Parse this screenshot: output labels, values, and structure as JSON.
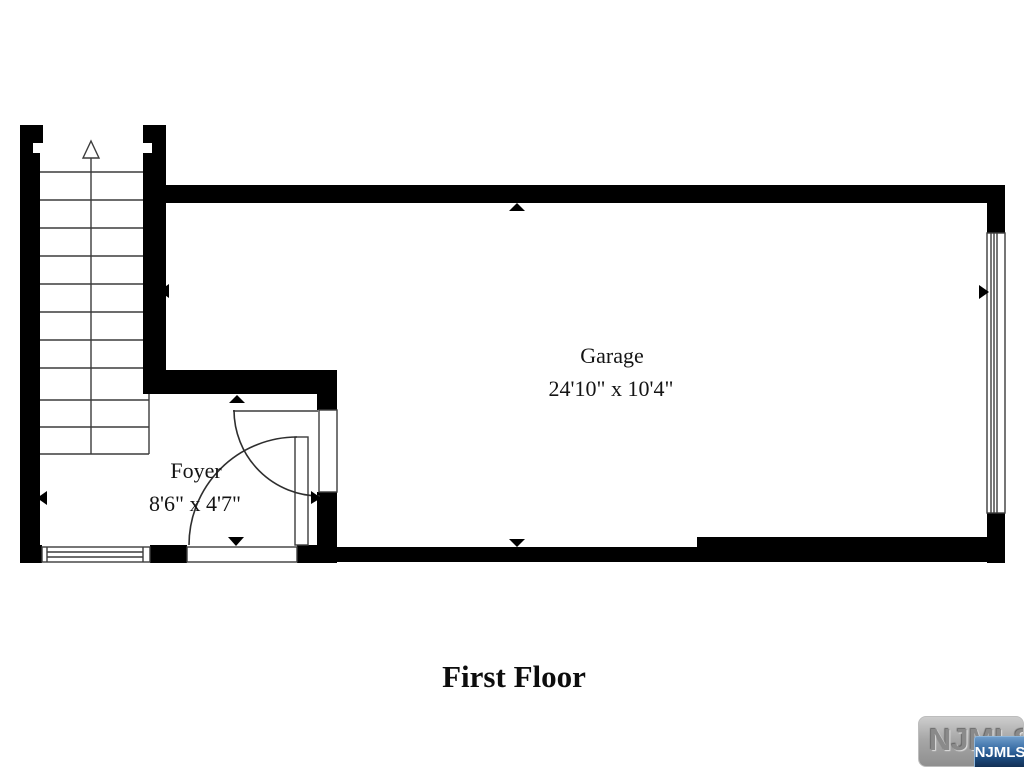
{
  "plan": {
    "title": "First Floor",
    "rooms": {
      "garage": {
        "name": "Garage",
        "dimensions": "24'10\" x 10'4\""
      },
      "foyer": {
        "name": "Foyer",
        "dimensions": "8'6\" x 4'7\""
      }
    }
  },
  "watermark": {
    "brand_text": "NJMLS",
    "badge_text": "NJMLS"
  },
  "colors": {
    "wall": "#000000",
    "thin_line": "#3c3c3c",
    "background": "#ffffff",
    "badge_blue_top": "#6e9cc9",
    "badge_blue_bottom": "#123055",
    "tag_gray": "#a7a7a7"
  }
}
